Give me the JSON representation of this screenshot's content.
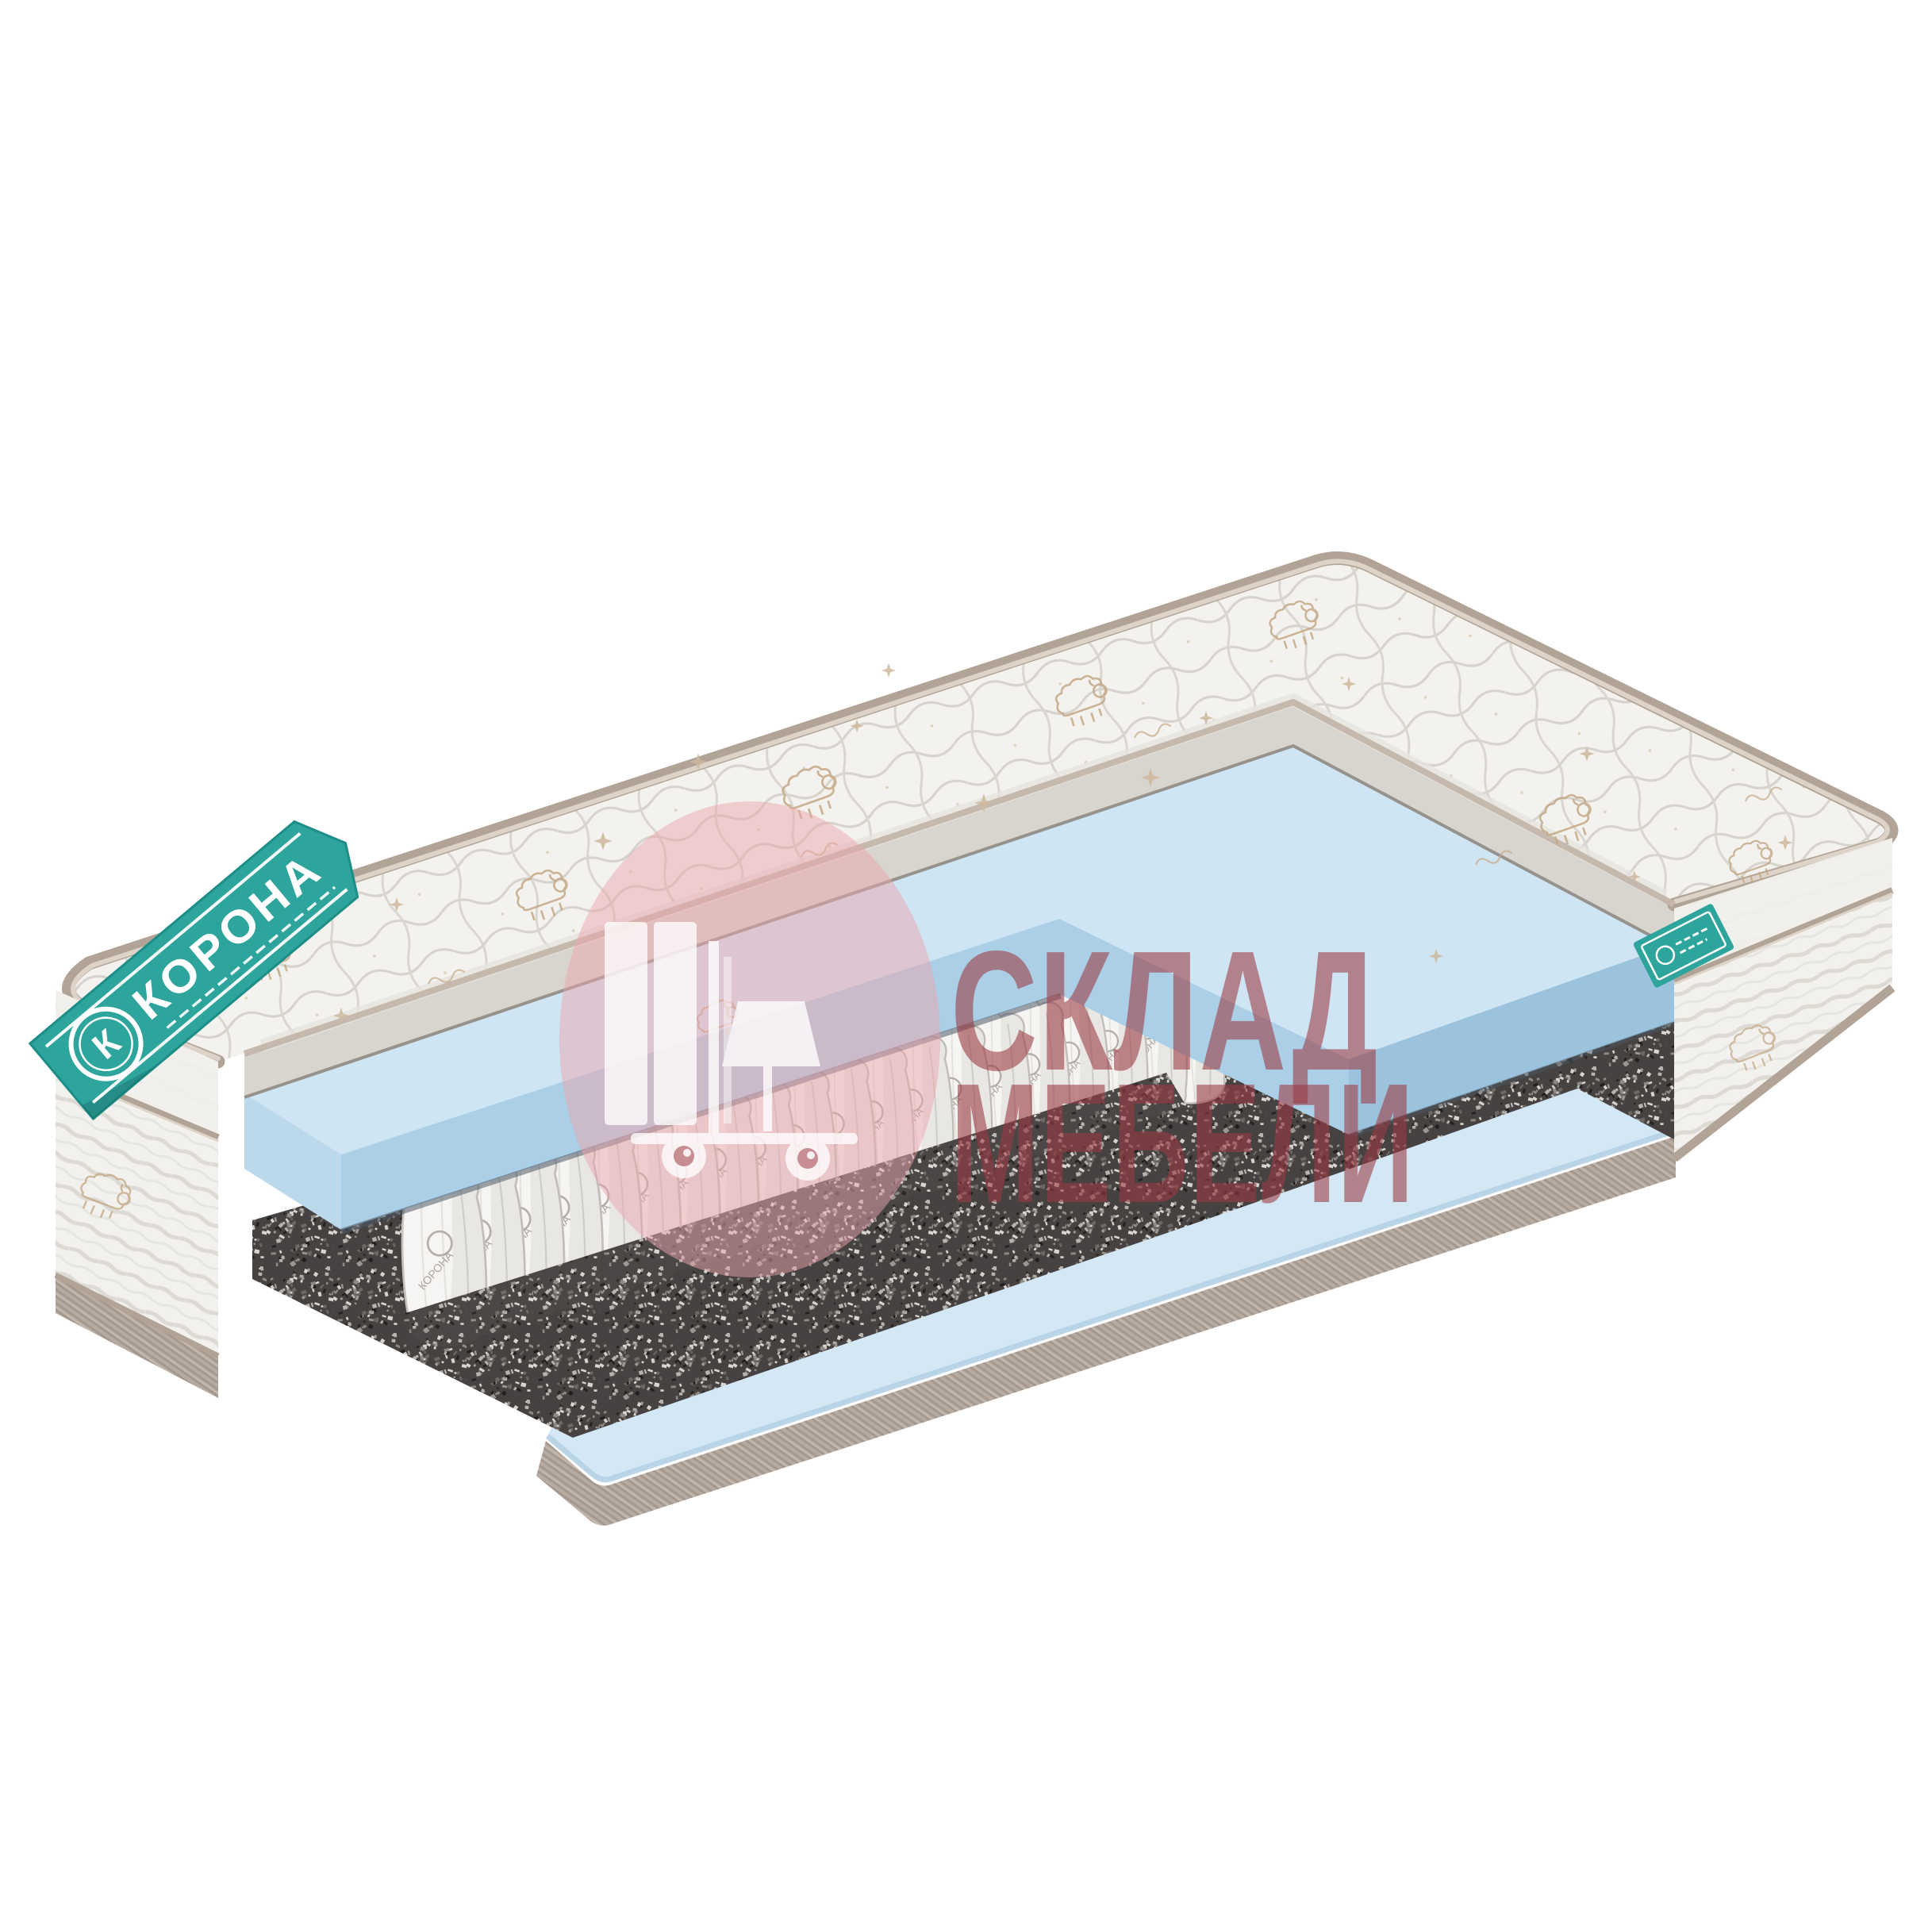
{
  "meta": {
    "description": "Product photo: cutaway view of a pocket-spring baby mattress on white background",
    "background": "#ffffff"
  },
  "brand": {
    "name": "КОРОНА",
    "logo_letter": "К",
    "spring_print": "КОРОНА",
    "ribbon_color": "#2da49c",
    "ribbon_edge": "#1d8d87",
    "tag_color": "#2da49c"
  },
  "watermark": {
    "line1": "СКЛАД",
    "line2": "МЕБЕЛИ",
    "text_color": "#9c3a43",
    "circle_color": "#eba6ad",
    "icon_color": "#ffffff",
    "icon": "forklift-with-furniture"
  },
  "springs": {
    "count": 20
  },
  "colors": {
    "quilt": "#f3f2ee",
    "quilt_section": "#d8d5cf",
    "quilt_stitch": "#d5d3cc",
    "piping": "#b1a396",
    "piping_light": "#ddd3c8",
    "foam_top": "#cfe5f4",
    "foam_face": "#abcfe7",
    "foam_face_dark": "#9cc3dd",
    "foam_left_face": "#bcd9ec",
    "foam_bottom": "#d3e7f5",
    "felt": "#454241",
    "base_cover": "#b7aaa0",
    "base_cover_line": "#a3968c",
    "side_fabric": "#f2f1ed",
    "motif": "#c4a987",
    "spring_body": "#f6f5f3",
    "spring_outline": "#c6c2bc"
  }
}
